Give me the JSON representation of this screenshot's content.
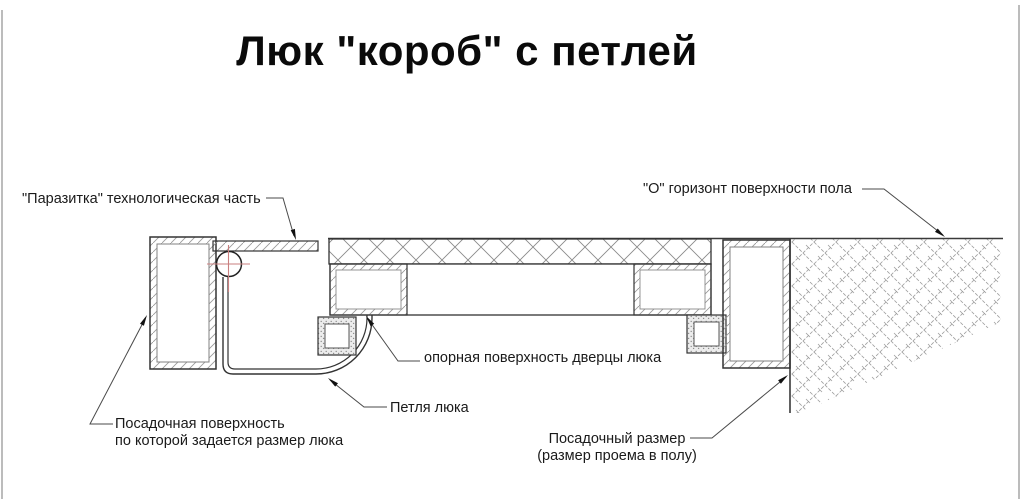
{
  "title": "Люк \"короб\" с петлей",
  "labels": {
    "parasite": "\"Паразитка\" технологическая часть",
    "floor_horizon": "\"О\" горизонт поверхности пола",
    "door_support": "опорная поверхность дверцы люка",
    "hinge": "Петля люка",
    "seating_surface_line1": "Посадочная поверхность",
    "seating_surface_line2": "по которой задается размер люка",
    "seating_size_line1": "Посадочный размер",
    "seating_size_line2": "(размер проема в полу)"
  },
  "colors": {
    "outline": "#333333",
    "hatch": "#999999",
    "centerline_red": "#c97f7f",
    "leader": "#4a4a4a",
    "page_border": "#b5b5b5"
  }
}
